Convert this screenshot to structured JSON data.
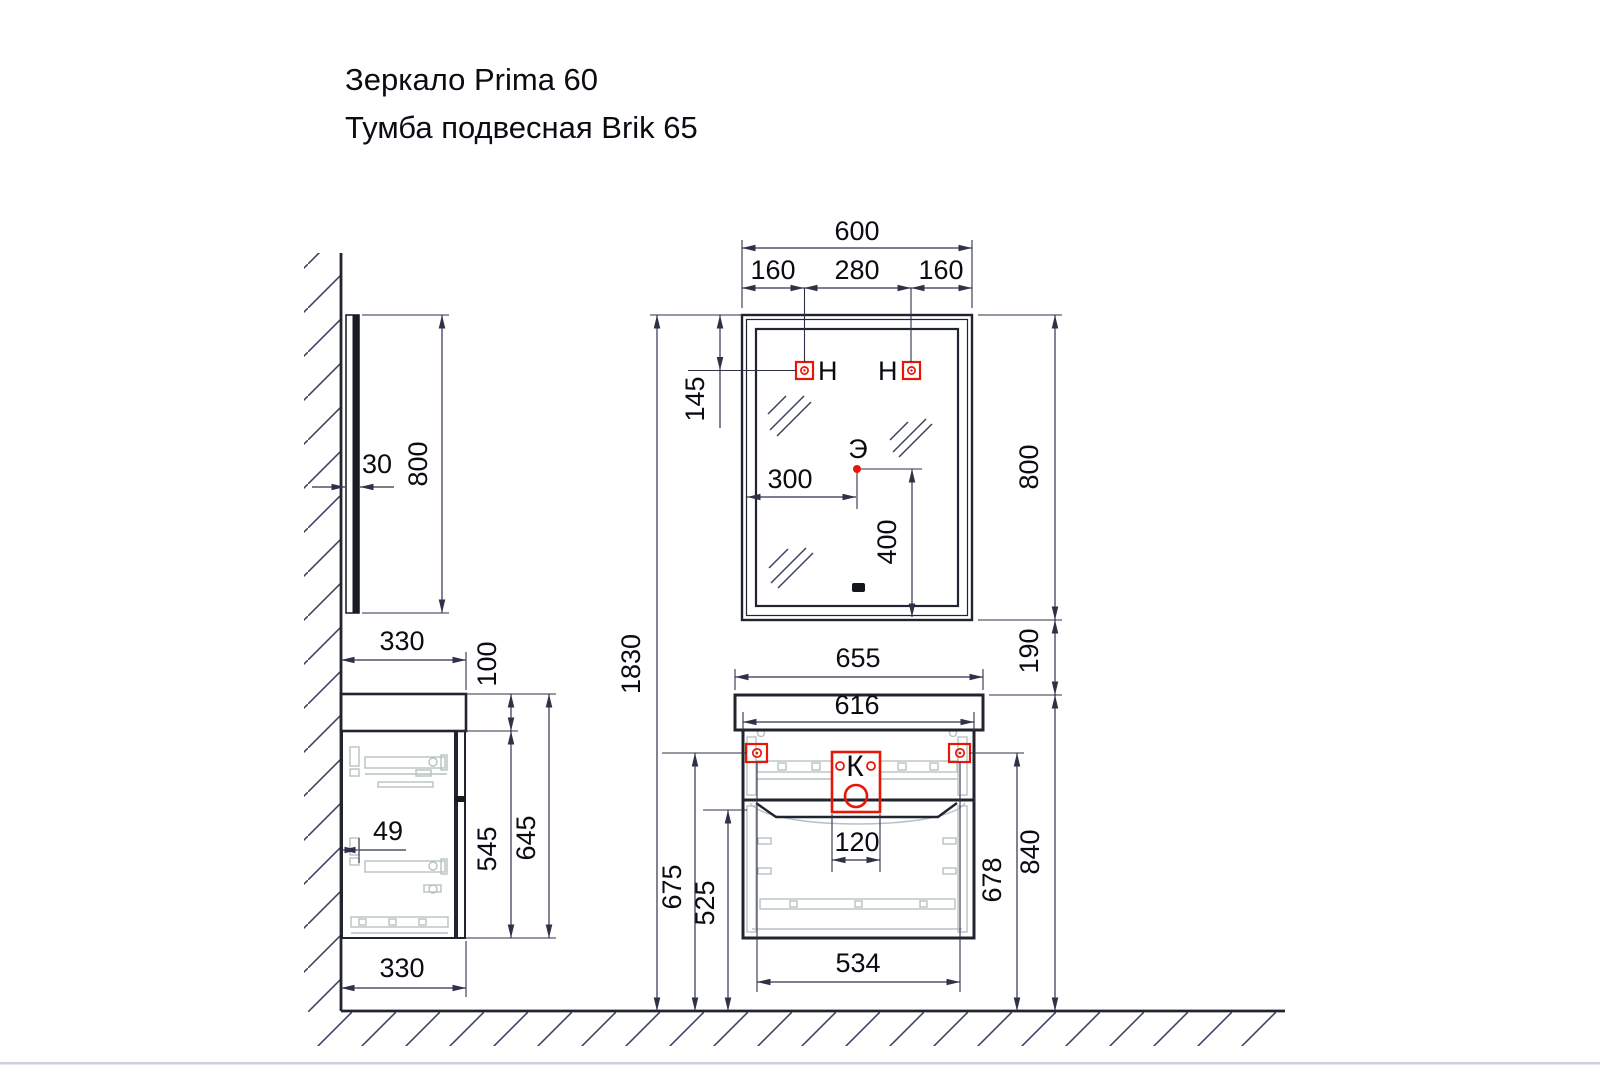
{
  "title": {
    "line1": "Зеркало Prima 60",
    "line2": "Тумба подвесная Brik 65"
  },
  "markers": {
    "hanger_left": "H",
    "hanger_right": "H",
    "socket": "Э",
    "drain": "К"
  },
  "dims": {
    "mirror_width": "600",
    "hole_left": "160",
    "hole_center": "280",
    "hole_right": "160",
    "hole_top_offset": "145",
    "mirror_height": "800",
    "gap_mirror_vanity": "190",
    "total_height": "1830",
    "socket_from_left": "300",
    "socket_from_bottom": "400",
    "basin_width": "655",
    "cabinet_width": "616",
    "drain_width": "120",
    "bracket_span": "534",
    "floor_to_divider": "525",
    "floor_to_left_bracket": "675",
    "floor_to_right_bracket": "678",
    "floor_to_basin_top": "840",
    "side_mirror_thickness": "30",
    "side_mirror_height": "800",
    "side_basin_depth": "330",
    "side_basin_height": "100",
    "side_cabinet_height": "545",
    "side_total_height": "645",
    "side_rail_offset": "49",
    "side_bottom_depth": "330"
  },
  "colors": {
    "line": "#20242f",
    "dimension": "#2e3248",
    "accent_red": "#e81607",
    "hardware_gray": "#b6c2c1"
  }
}
